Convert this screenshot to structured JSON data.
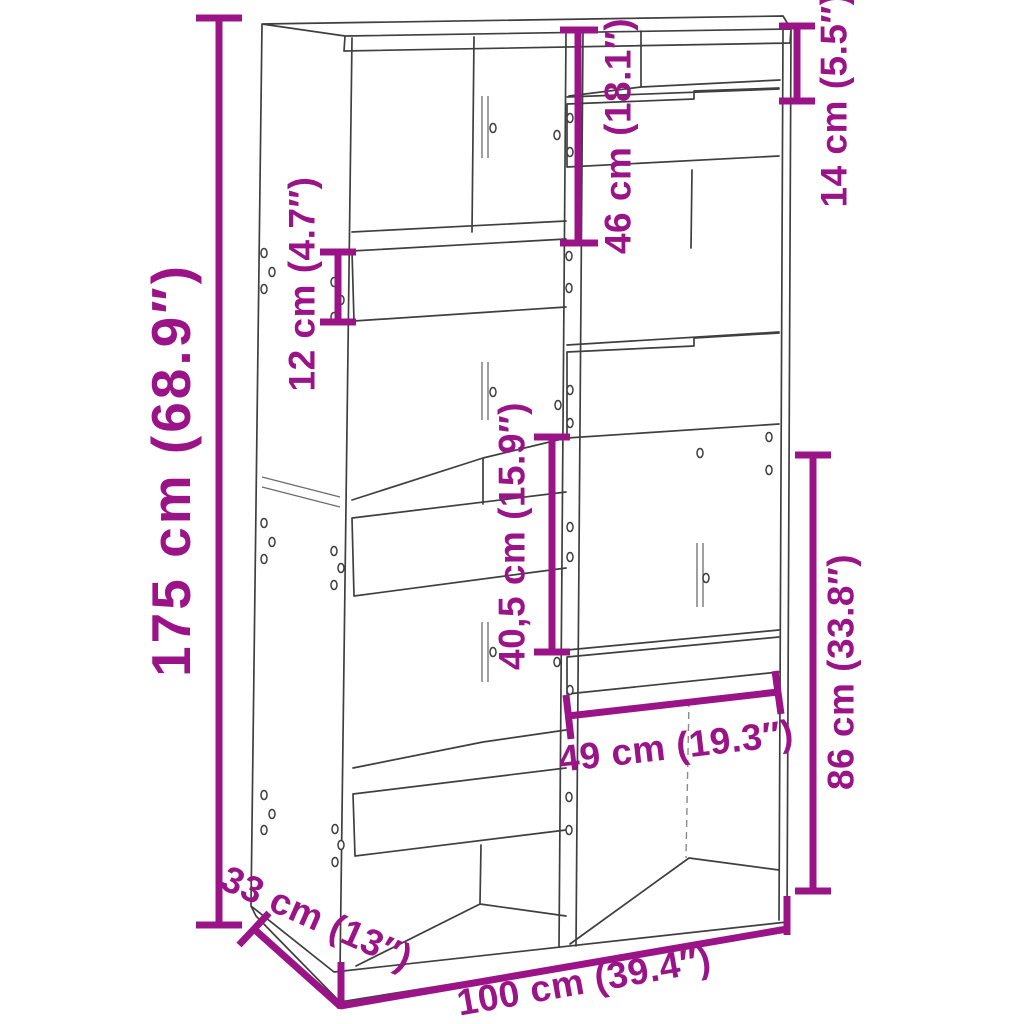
{
  "image_type": "product-dimension-diagram",
  "product": "bookcase-room-divider-line-drawing",
  "colors": {
    "accent": "#9B1487",
    "line": "#3F3F3F",
    "background": "#FFFFFF"
  },
  "dimensions": {
    "height": "175 cm (68.9″)",
    "width": "100 cm (39.4″)",
    "depth": "33 cm (13″)",
    "top_right_gap": "14 cm (5.5″)",
    "upper_compartment": "46 cm (18.1″)",
    "board_height": "12 cm (4.7″)",
    "middle_compartment": "40,5 cm (15.9″)",
    "compartment_width": "49 cm (19.3″)",
    "lower_section": "86 cm (33.8″)"
  }
}
